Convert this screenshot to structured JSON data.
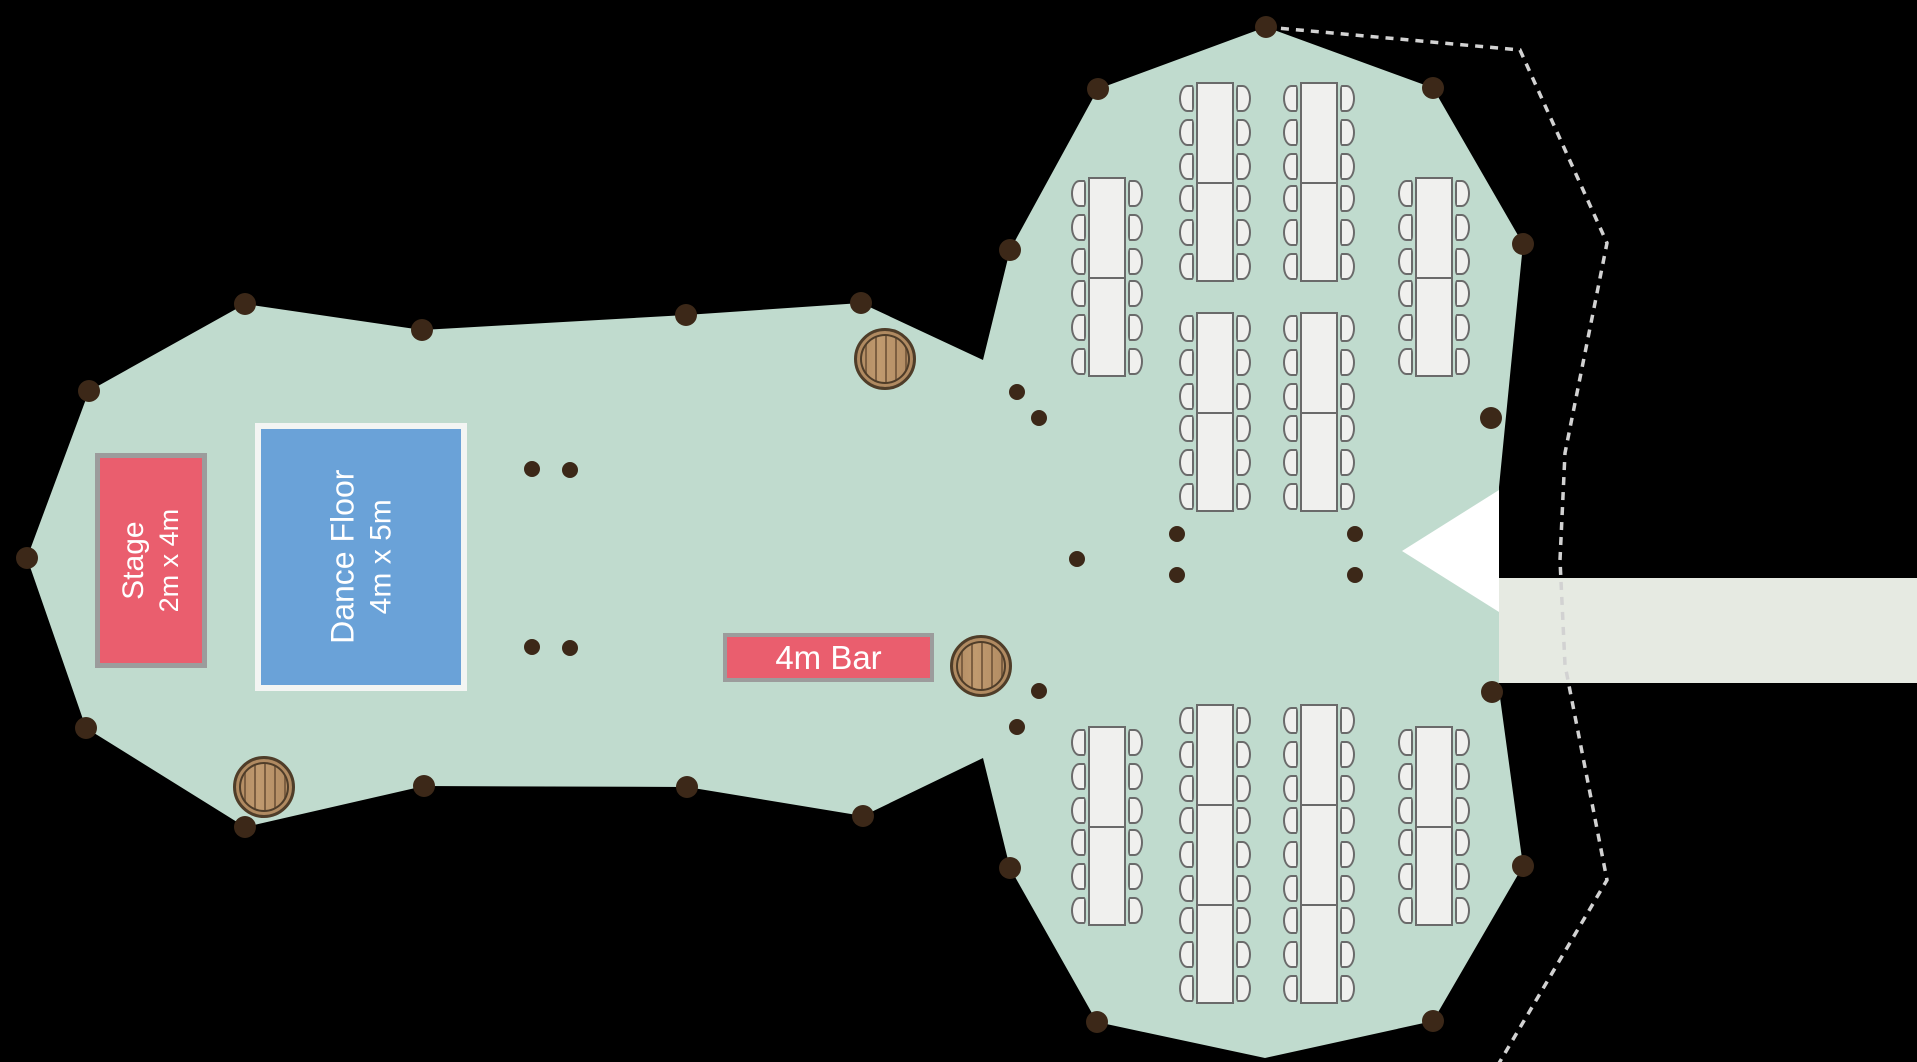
{
  "canvas": {
    "width": 1917,
    "height": 1062
  },
  "colors": {
    "background": "#000000",
    "tent": "#c0dbce",
    "walkway": "#e6eae2",
    "entrance": "#ffffff",
    "dotted_line": "#d2d2d2",
    "table_fill": "#f0f0ee",
    "table_border": "#6a6a6a",
    "pole": "#3c2818",
    "stage_fill": "#ea5e6e",
    "stage_border": "#9c9c9c",
    "dance_fill": "#6aa2d8",
    "dance_border": "#f3f5f3",
    "bar_fill": "#ea5e6e",
    "bar_border": "#9c9c9c",
    "barrel_fill": "#b08a61",
    "barrel_ring": "#4f3d29",
    "barrel_plank": "#7d5f41"
  },
  "stage": {
    "label": "Stage",
    "dimensions": "2m x 4m",
    "x": 95,
    "y": 453,
    "width": 112,
    "height": 215
  },
  "dance_floor": {
    "label": "Dance Floor",
    "dimensions": "4m x 5m",
    "x": 255,
    "y": 423,
    "width": 212,
    "height": 268
  },
  "bar": {
    "label": "4m Bar",
    "x": 723,
    "y": 633,
    "width": 211,
    "height": 49
  },
  "tent_outline": [
    [
      245,
      304
    ],
    [
      422,
      330
    ],
    [
      686,
      315
    ],
    [
      861,
      303
    ],
    [
      983,
      360
    ],
    [
      1010,
      250
    ],
    [
      1098,
      89
    ],
    [
      1266,
      27
    ],
    [
      1433,
      88
    ],
    [
      1523,
      244
    ],
    [
      1499,
      487
    ],
    [
      1499,
      690
    ],
    [
      1523,
      866
    ],
    [
      1433,
      1021
    ],
    [
      1265,
      1058
    ],
    [
      1097,
      1022
    ],
    [
      1010,
      868
    ],
    [
      983,
      758
    ],
    [
      863,
      816
    ],
    [
      687,
      787
    ],
    [
      424,
      786
    ],
    [
      245,
      827
    ],
    [
      86,
      728
    ],
    [
      27,
      558
    ],
    [
      89,
      391
    ]
  ],
  "dotted_path": [
    [
      1266,
      27
    ],
    [
      1520,
      50
    ],
    [
      1607,
      243
    ],
    [
      1565,
      453
    ],
    [
      1560,
      560
    ],
    [
      1565,
      665
    ],
    [
      1607,
      880
    ],
    [
      1495,
      1070
    ]
  ],
  "walkway": {
    "x": 1499,
    "y": 578,
    "width": 418,
    "height": 105
  },
  "entrance_triangle": [
    [
      1499,
      490
    ],
    [
      1402,
      551
    ],
    [
      1499,
      612
    ]
  ],
  "tables": {
    "width": 38,
    "segment_height": 100,
    "chairs_per_segment_side": 3,
    "items": [
      {
        "x": 1196,
        "y": 82,
        "segments": 2
      },
      {
        "x": 1300,
        "y": 82,
        "segments": 2
      },
      {
        "x": 1196,
        "y": 312,
        "segments": 2
      },
      {
        "x": 1300,
        "y": 312,
        "segments": 2
      },
      {
        "x": 1088,
        "y": 177,
        "segments": 2
      },
      {
        "x": 1415,
        "y": 177,
        "segments": 2
      },
      {
        "x": 1196,
        "y": 704,
        "segments": 3
      },
      {
        "x": 1300,
        "y": 704,
        "segments": 3
      },
      {
        "x": 1088,
        "y": 726,
        "segments": 2
      },
      {
        "x": 1415,
        "y": 726,
        "segments": 2
      }
    ]
  },
  "barrels": {
    "radius": 28,
    "items": [
      {
        "cx": 261,
        "cy": 784
      },
      {
        "cx": 882,
        "cy": 356
      },
      {
        "cx": 978,
        "cy": 663
      }
    ]
  },
  "poles": {
    "perimeter_radius": 11,
    "interior_radius": 8,
    "perimeter": [
      {
        "x": 245,
        "y": 304
      },
      {
        "x": 422,
        "y": 330
      },
      {
        "x": 686,
        "y": 315
      },
      {
        "x": 861,
        "y": 303
      },
      {
        "x": 1010,
        "y": 250
      },
      {
        "x": 1098,
        "y": 89
      },
      {
        "x": 1266,
        "y": 27
      },
      {
        "x": 1433,
        "y": 88
      },
      {
        "x": 1523,
        "y": 244
      },
      {
        "x": 1491,
        "y": 418
      },
      {
        "x": 1492,
        "y": 692
      },
      {
        "x": 1523,
        "y": 866
      },
      {
        "x": 1433,
        "y": 1021
      },
      {
        "x": 1097,
        "y": 1022
      },
      {
        "x": 1010,
        "y": 868
      },
      {
        "x": 863,
        "y": 816
      },
      {
        "x": 687,
        "y": 787
      },
      {
        "x": 424,
        "y": 786
      },
      {
        "x": 245,
        "y": 827
      },
      {
        "x": 86,
        "y": 728
      },
      {
        "x": 27,
        "y": 558
      },
      {
        "x": 89,
        "y": 391
      }
    ],
    "interior": [
      {
        "x": 532,
        "y": 469
      },
      {
        "x": 570,
        "y": 470
      },
      {
        "x": 532,
        "y": 647
      },
      {
        "x": 570,
        "y": 648
      },
      {
        "x": 1017,
        "y": 392
      },
      {
        "x": 1039,
        "y": 418
      },
      {
        "x": 1039,
        "y": 691
      },
      {
        "x": 1017,
        "y": 727
      },
      {
        "x": 1077,
        "y": 559
      },
      {
        "x": 1177,
        "y": 534
      },
      {
        "x": 1355,
        "y": 534
      },
      {
        "x": 1177,
        "y": 575
      },
      {
        "x": 1355,
        "y": 575
      }
    ]
  }
}
